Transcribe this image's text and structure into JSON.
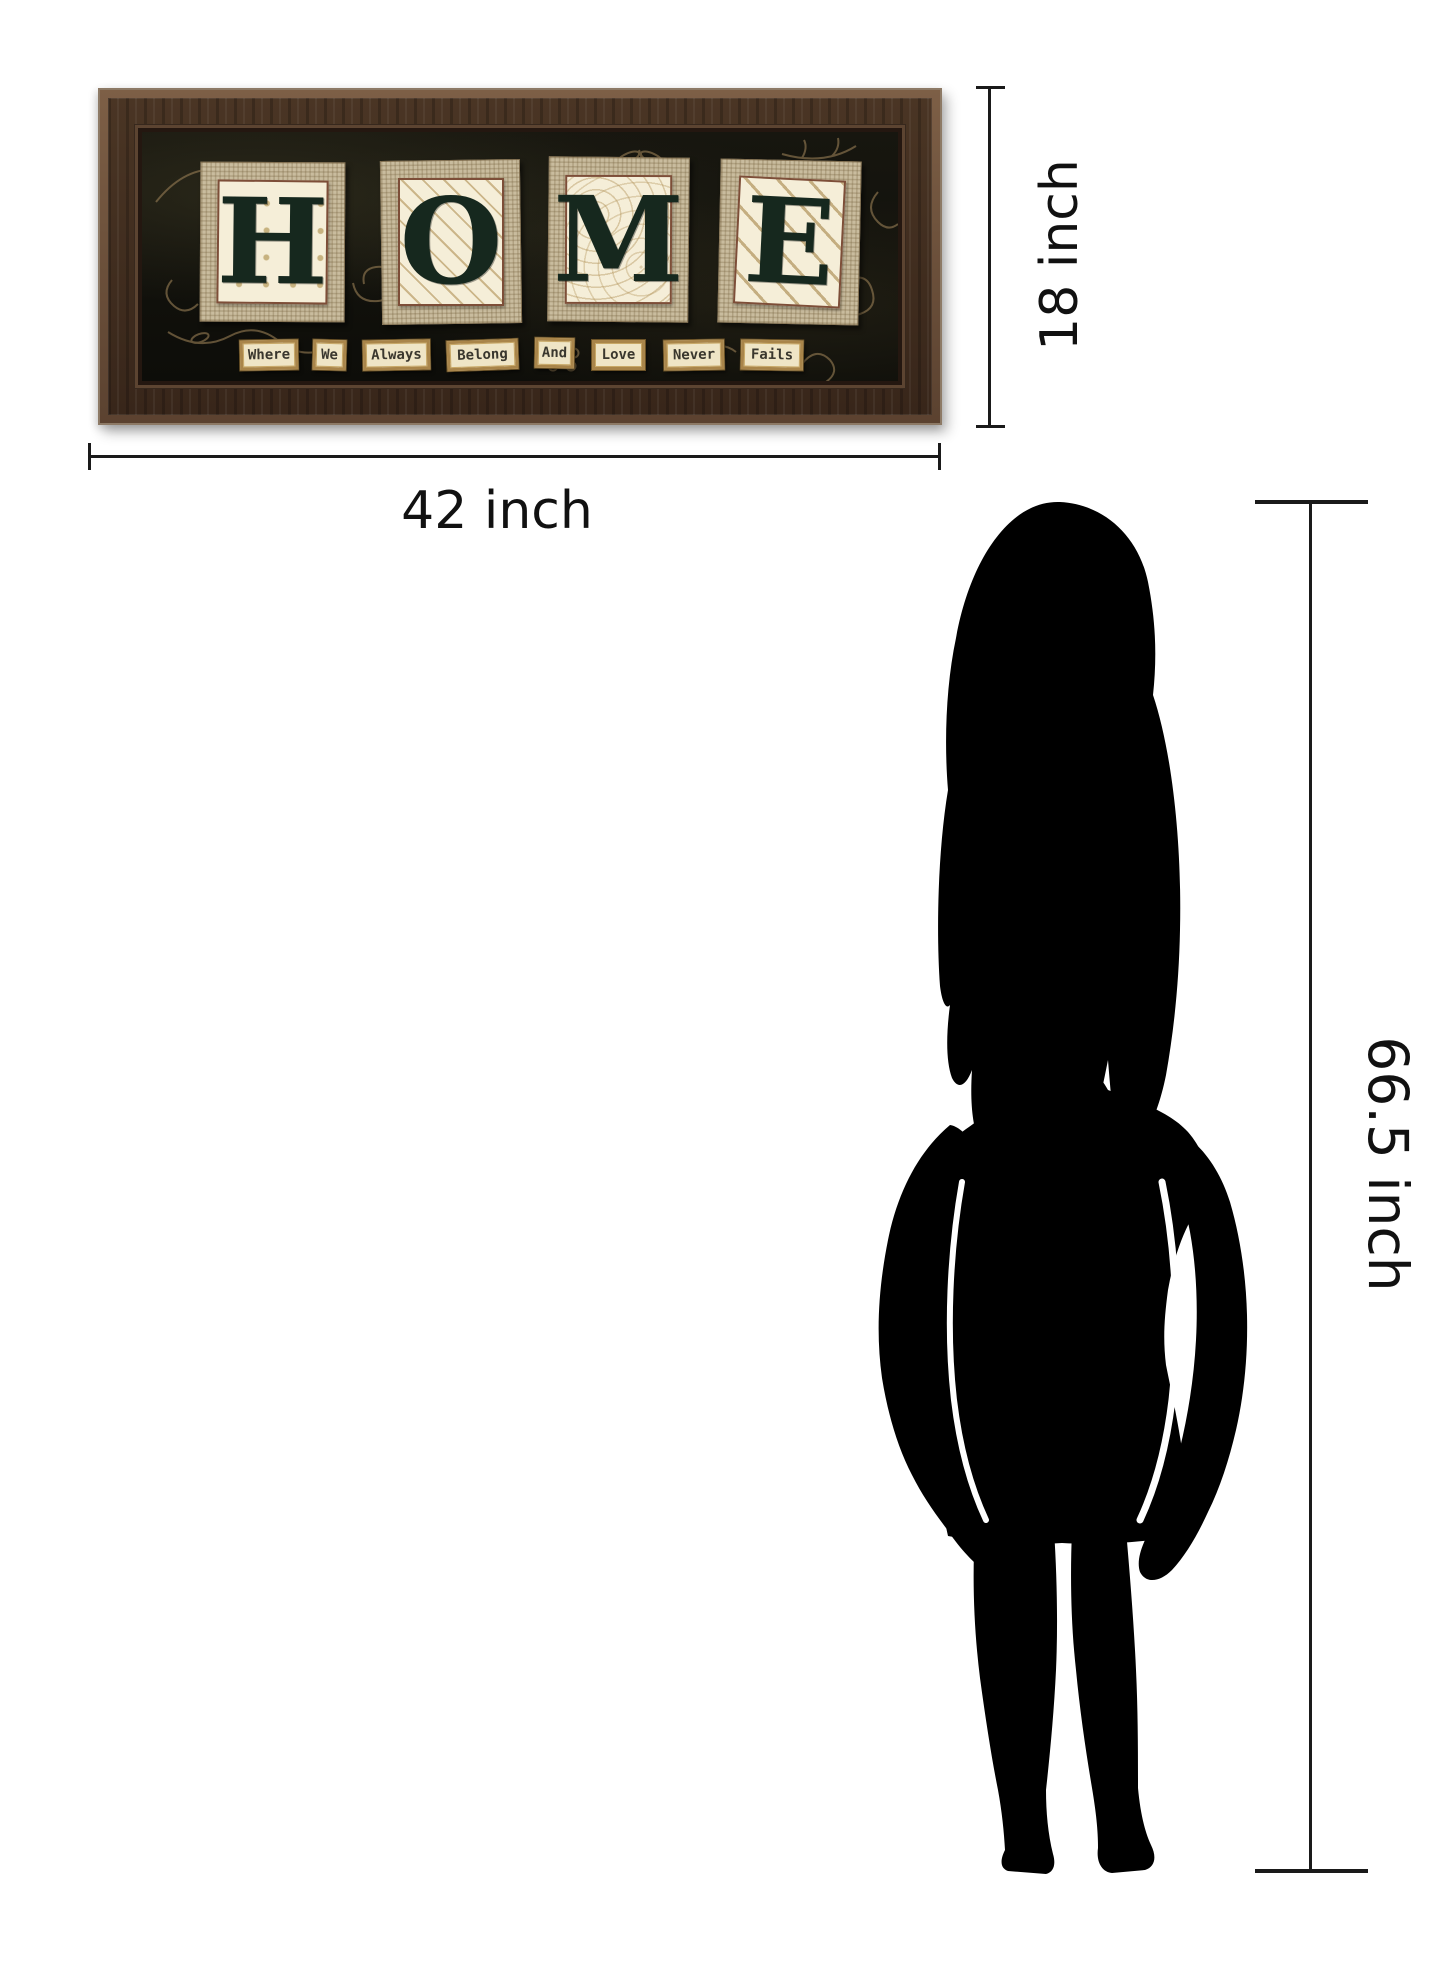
{
  "canvas": {
    "width": 1445,
    "height": 1973,
    "background": "#ffffff"
  },
  "artwork": {
    "letters": [
      "H",
      "O",
      "M",
      "E"
    ],
    "word_tiles": [
      "Where",
      "We",
      "Always",
      "Belong",
      "And",
      "Love",
      "Never",
      "Fails"
    ],
    "colors": {
      "frame_wood": "#43301f",
      "art_background": "#14130e",
      "burlap": "#c9bc9e",
      "panel_cream": "#f5eed8",
      "letter_green": "#16281e",
      "doodle_gold": "#8f7750",
      "word_tile_gold": "#a9854a"
    }
  },
  "dimensions": {
    "width_label": "42 inch",
    "height_label": "18 inch",
    "person_height_label": "66.5 inch",
    "line_color": "#1a1a1a"
  },
  "silhouette": {
    "subject": "standing woman",
    "color": "#000000"
  }
}
